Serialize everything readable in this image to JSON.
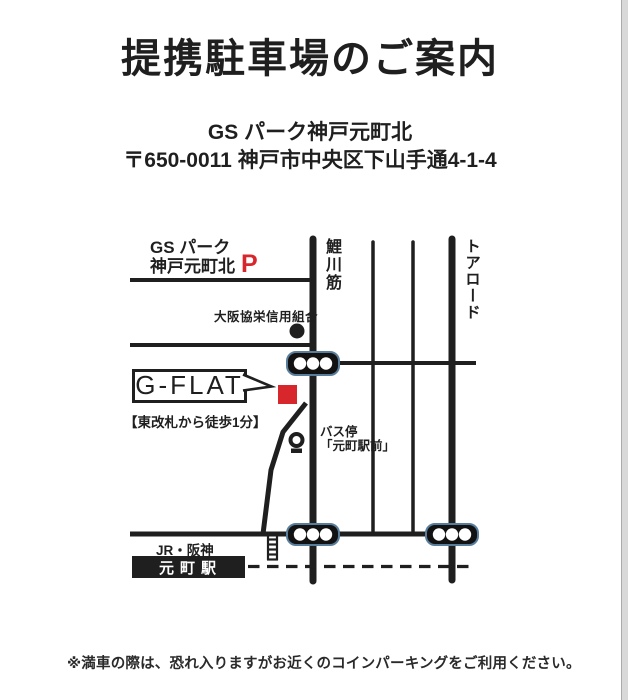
{
  "document": {
    "title": "提携駐車場のご案内",
    "parking_name": "GS パーク神戸元町北",
    "parking_address": "〒650-0011 神戸市中央区下山手通4-1-4",
    "footnote": "※満車の際は、恐れ入りますがお近くのコインパーキングをご利用ください。"
  },
  "map": {
    "parking": {
      "label_line1": "GS パーク",
      "label_line2": "神戸元町北",
      "p_mark": "P"
    },
    "bank_label": "大阪協栄信用組合",
    "roads": {
      "vertical_main": "鯉川筋",
      "vertical_right": "トアロード"
    },
    "destination": {
      "name": "G-FLAT",
      "walk_note": "【東改札から徒歩1分】"
    },
    "bus_stop": {
      "label": "バス停",
      "name": "「元町駅前」"
    },
    "station": {
      "lines": "JR・阪神",
      "name": "元町駅"
    },
    "icons": {
      "destination-marker": "red-filled-square",
      "bank-dot-icon": "black-filled-circle",
      "traffic-light-icon": "rounded-black-bar-with-three-white-dots",
      "bus-stop-icon": "circle-sign-on-base",
      "station-stairs-icon": "ladder-rungs",
      "railway-line": "black-dashed-line"
    },
    "colors": {
      "ink": "#1f1f1f",
      "accent_red": "#d7272c",
      "traffic_light_outline": "#587e9c"
    }
  }
}
